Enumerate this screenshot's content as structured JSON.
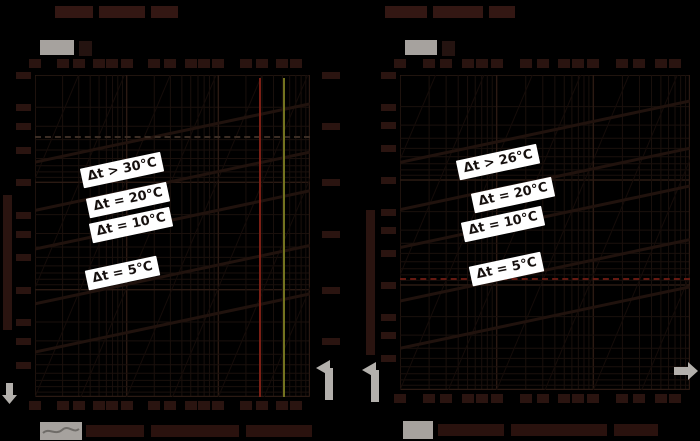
{
  "page": {
    "background": "#000000"
  },
  "colors": {
    "annotation_box": "#ffffff",
    "annotation_text": "#16100e",
    "red_reference_line": "#7a1f15",
    "olive_reference_line": "#73731f",
    "red_dashed_line": "#641a12",
    "grey_arrow": "#b3b0ac",
    "grey_legend_chip": "#a6a29e"
  },
  "charts": [
    {
      "labels": [
        "Δt > 30°C",
        "Δt = 20°C",
        "Δt = 10°C",
        "Δt = 5°C"
      ]
    },
    {
      "labels": [
        "Δt > 26°C",
        "Δt = 20°C",
        "Δt = 10°C",
        "Δt = 5°C"
      ]
    }
  ],
  "chart_data": [
    {
      "type": "line",
      "title": "",
      "scale": {
        "x": "log",
        "y": "log"
      },
      "grid": true,
      "series": [
        {
          "name": "Δt > 30°C"
        },
        {
          "name": "Δt = 20°C"
        },
        {
          "name": "Δt = 10°C"
        },
        {
          "name": "Δt = 5°C"
        }
      ],
      "reference_lines": [
        {
          "orientation": "vertical",
          "style": "solid",
          "color": "#7a1f15"
        },
        {
          "orientation": "vertical",
          "style": "solid",
          "color": "#73731f"
        },
        {
          "orientation": "horizontal",
          "style": "dashed",
          "color": "#3b2d24"
        }
      ],
      "note": "axis tick labels, titles and legend text are illegible (near-black on black) in source image"
    },
    {
      "type": "line",
      "title": "",
      "scale": {
        "x": "log",
        "y": "log"
      },
      "grid": true,
      "series": [
        {
          "name": "Δt > 26°C"
        },
        {
          "name": "Δt = 20°C"
        },
        {
          "name": "Δt = 10°C"
        },
        {
          "name": "Δt = 5°C"
        }
      ],
      "reference_lines": [
        {
          "orientation": "horizontal",
          "style": "dashed",
          "color": "#641a12"
        }
      ],
      "note": "axis tick labels, titles and legend text are illegible (near-black on black) in source image"
    }
  ]
}
